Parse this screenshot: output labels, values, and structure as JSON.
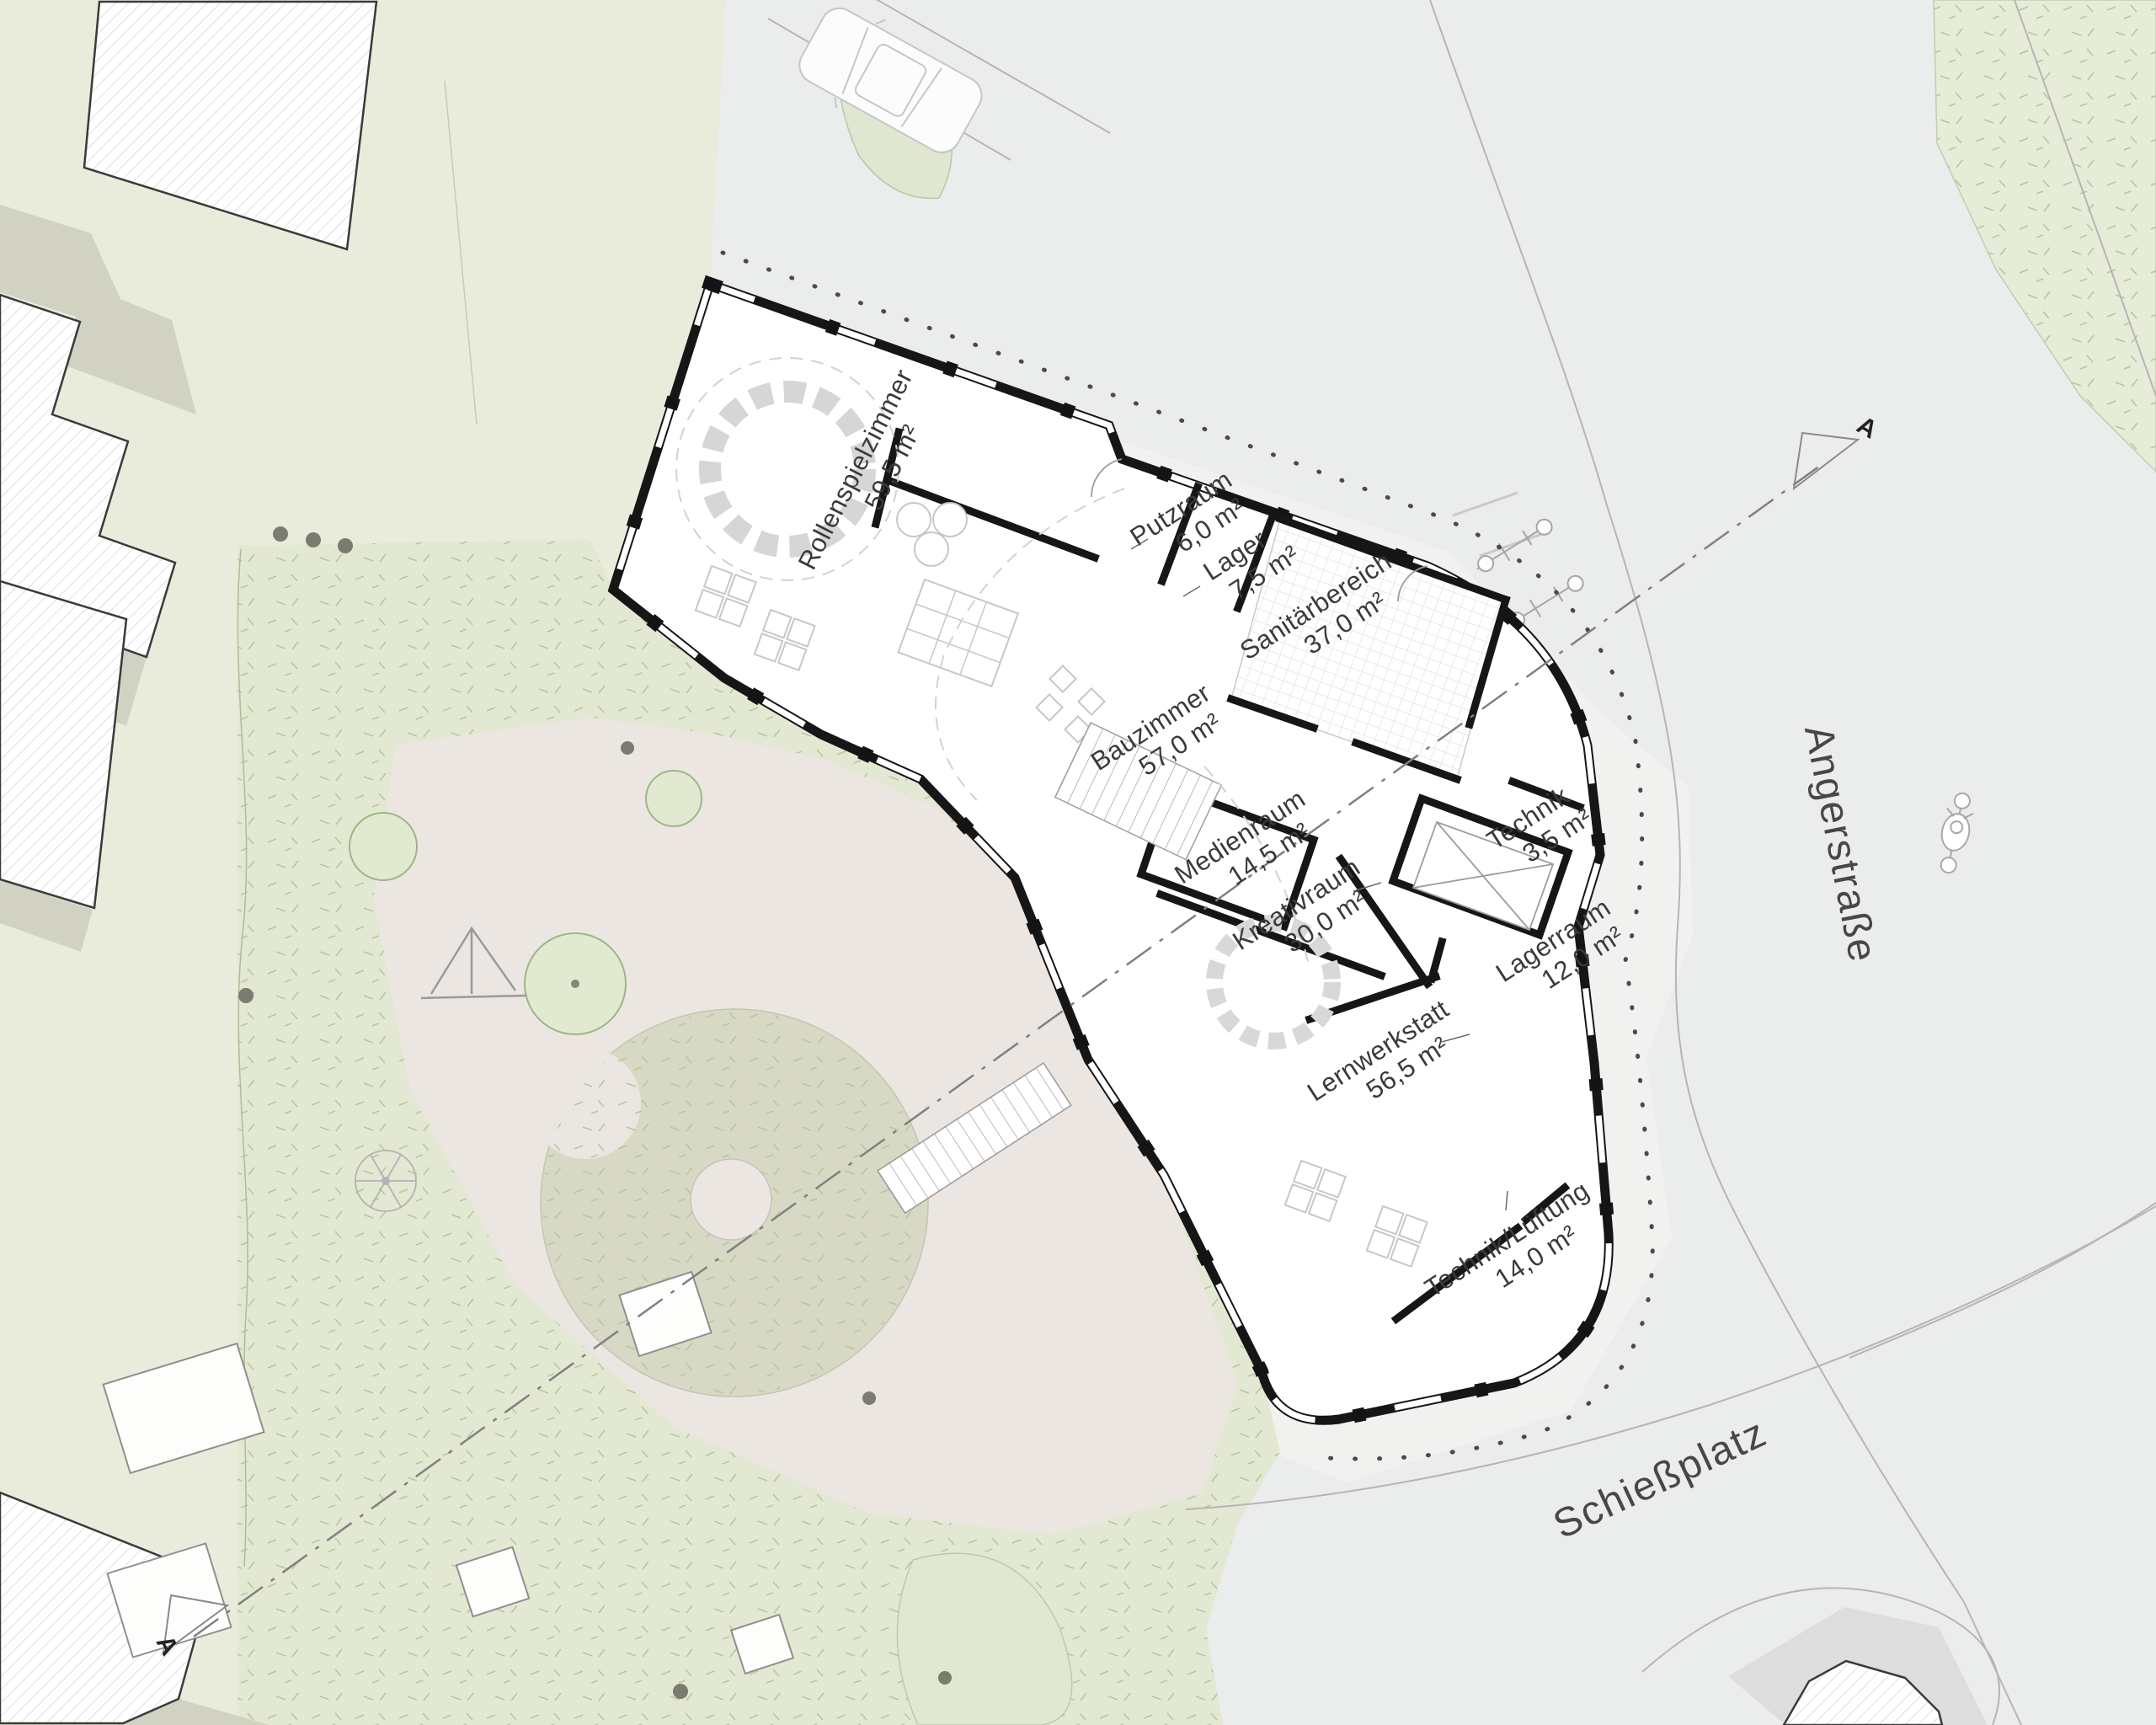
{
  "site_plan": {
    "rooms": [
      {
        "name": "Rollenspielzimmer",
        "area": "59,5 m²"
      },
      {
        "name": "Putzraum",
        "area": "6,0 m²"
      },
      {
        "name": "Lager",
        "area": "7,5 m²"
      },
      {
        "name": "Sanitärbereich",
        "area": "37,0 m²"
      },
      {
        "name": "Bauzimmer",
        "area": "57,0 m²"
      },
      {
        "name": "Medienraum",
        "area": "14,5 m²"
      },
      {
        "name": "Kreativraum",
        "area": "30,0 m²"
      },
      {
        "name": "Technik",
        "area": "3,5 m²"
      },
      {
        "name": "Lagerraum",
        "area": "12,0 m²"
      },
      {
        "name": "Lernwerkstatt",
        "area": "56,5 m²"
      },
      {
        "name": "Technik/Lüftung",
        "area": "14,0 m²"
      }
    ],
    "streets": [
      {
        "name": "Angerstraße"
      },
      {
        "name": "Schießplatz"
      }
    ],
    "section": {
      "marker": "A"
    },
    "colors": {
      "wall": "#161616",
      "site_green": "#e9ecdb",
      "lawn_green": "#e3e8d3",
      "courtyard_pink": "#ece6e2",
      "road_gray": "#ebecec",
      "mound_sage": "#d8d9c5",
      "shadow_green": "#d1d2c1",
      "text": "#3a3a3a"
    }
  }
}
